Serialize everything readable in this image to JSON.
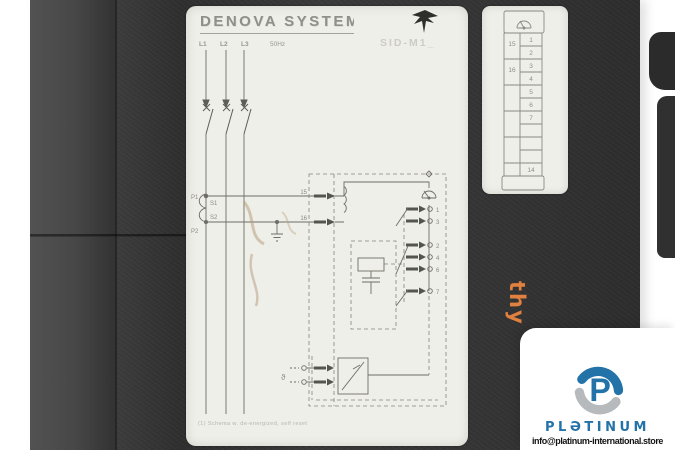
{
  "device": {
    "side_text": "thy",
    "side_text_color": "#e0813f",
    "body_color": "#363636"
  },
  "label": {
    "brand": "DENOVA SYSTEM",
    "model": "SID-M1_",
    "frequency": "50Hz",
    "phases": [
      "L1",
      "L2",
      "L3"
    ],
    "ct": {
      "p1": "P1",
      "s1": "S1",
      "s2": "S2",
      "p2": "P2"
    },
    "input_terminals": {
      "t15": "15",
      "t16": "16"
    },
    "output_terminals": [
      "1",
      "3",
      "2",
      "4",
      "6",
      "7"
    ],
    "thermistor_symbol": "ϑ",
    "footnote": "(1) Schema w. de-energized, self reset"
  },
  "terminal_strip": {
    "left_cells": [
      "15",
      "16"
    ],
    "right_cells": [
      "1",
      "2",
      "3",
      "4",
      "5",
      "6",
      "7"
    ],
    "lower_cell": "14"
  },
  "watermark": {
    "brand": "PLƏTINUM",
    "logo_letter": "P",
    "email": "info@platinum-international.store",
    "blue": "#2372a8",
    "gray": "#b6babd"
  }
}
